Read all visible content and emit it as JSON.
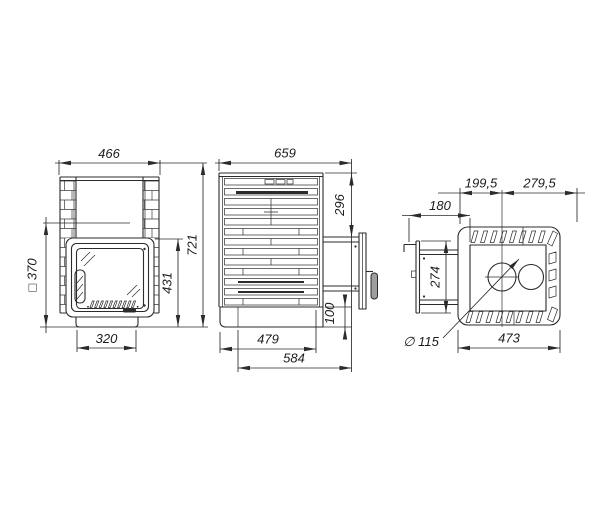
{
  "front_view": {
    "dims": {
      "width": "466",
      "opening": "□ 370",
      "height": "721",
      "door_height": "431",
      "base_width": "320"
    }
  },
  "side_view": {
    "dims": {
      "depth": "659",
      "door_top_offset": "296",
      "plinth_height": "100",
      "base_depth": "479",
      "depth_with_door": "584"
    }
  },
  "top_view": {
    "dims": {
      "front_to_flue_center": "199,5",
      "flue_center_to_back": "279,5",
      "door_protrusion": "180",
      "door_width": "274",
      "flue_diameter": "∅ 115",
      "body_depth": "473"
    }
  },
  "colors": {
    "line": "#2b2b2b",
    "handle_fill": "#9e9e9e",
    "background": "#ffffff"
  }
}
